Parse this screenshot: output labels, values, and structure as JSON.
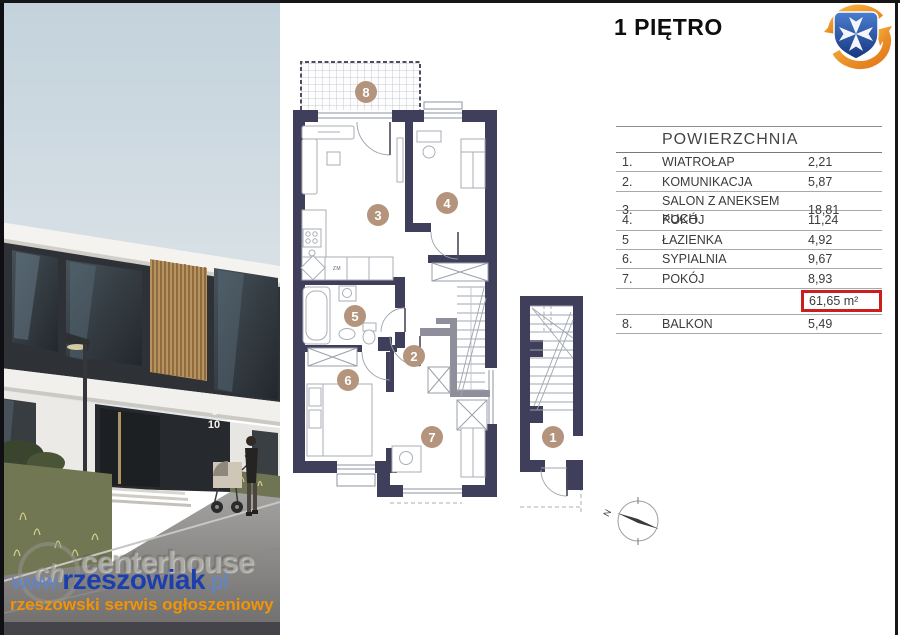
{
  "title": "1 PIĘTRO",
  "table": {
    "header": "POWIERZCHNIA",
    "rows": [
      {
        "no": "1.",
        "name": "WIATROŁAP",
        "value": "2,21"
      },
      {
        "no": "2.",
        "name": "KOMUNIKACJA",
        "value": "5,87"
      },
      {
        "no": "3.",
        "name": "SALON Z ANEKSEM KUCH.",
        "value": "18,81"
      },
      {
        "no": "4.",
        "name": "POKÓJ",
        "value": "11,24"
      },
      {
        "no": "5",
        "name": "ŁAZIENKA",
        "value": "4,92"
      },
      {
        "no": "6.",
        "name": "SYPIALNIA",
        "value": "9,67"
      },
      {
        "no": "7.",
        "name": "POKÓJ",
        "value": "8,93"
      }
    ],
    "total": {
      "value": "61,65 m²"
    },
    "extra_row": {
      "no": "8.",
      "name": "BALKON",
      "value": "5,49"
    }
  },
  "plan": {
    "rooms": [
      {
        "label": "1"
      },
      {
        "label": "2"
      },
      {
        "label": "3"
      },
      {
        "label": "4"
      },
      {
        "label": "5"
      },
      {
        "label": "6"
      },
      {
        "label": "7"
      },
      {
        "label": "8"
      }
    ],
    "kitchen_label": "ZM",
    "compass_label": "N"
  },
  "photo": {
    "house_numbers": [
      "9",
      "10"
    ]
  },
  "watermark": {
    "url_prefix": "www.",
    "url_main": "rzeszowiak",
    "url_suffix": ".pl",
    "subtitle": "rzeszowski serwis ogłoszeniowy",
    "embossed_monogram": "ch",
    "embossed_title": "centerhouse",
    "embossed_subtitle": "agencja nieruchomości"
  },
  "colors": {
    "wall": "#3f3f5b",
    "room_badge": "#b4947c",
    "highlight_red": "#cb1f1d",
    "watermark_blue": "#1d3fae",
    "watermark_orange": "#f39305",
    "logo_shield_blue": "#2b57a8",
    "logo_arrow_orange": "#f08a1d"
  }
}
